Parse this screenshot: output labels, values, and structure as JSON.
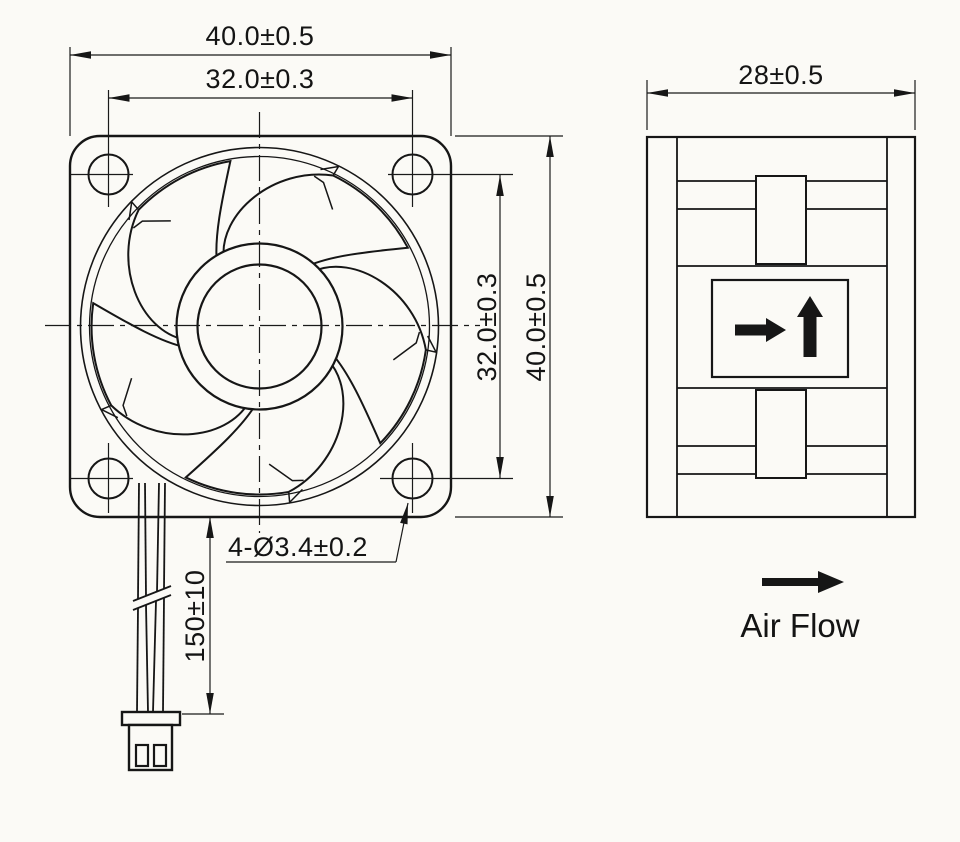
{
  "drawing": {
    "title_hint": "axial-fan-outline-drawing",
    "colors": {
      "background": "#fbfaf6",
      "line": "#1a1a1a",
      "text": "#141414",
      "arrow_fill": "#161616"
    },
    "front_view": {
      "dim_width_outer": "40.0±0.5",
      "dim_width_inner": "32.0±0.3",
      "dim_height_inner": "32.0±0.3",
      "dim_height_outer": "40.0±0.5",
      "mounting_holes_label": "4-Ø3.4±0.2",
      "wire_length_label": "150±10",
      "blade_count": 5,
      "mounting_hole_count": 4
    },
    "side_view": {
      "dim_depth": "28±0.5"
    },
    "airflow": {
      "label": "Air Flow"
    }
  }
}
